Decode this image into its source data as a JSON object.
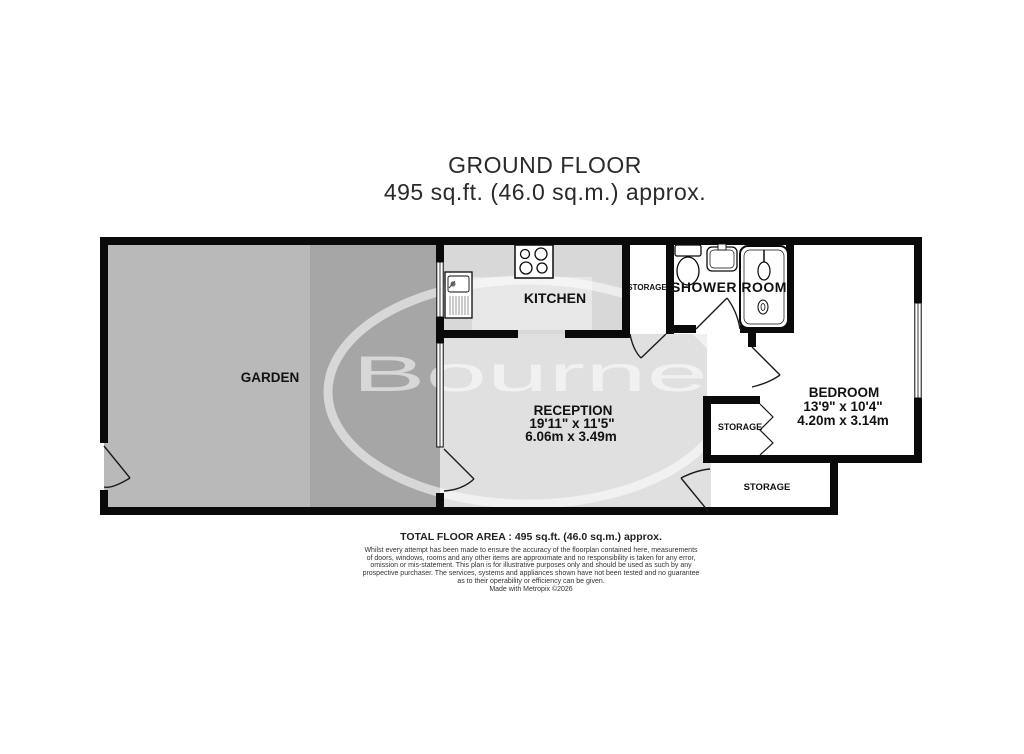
{
  "title": {
    "line1": "GROUND FLOOR",
    "line2": "495 sq.ft. (46.0 sq.m.) approx."
  },
  "watermark": {
    "text": "Bourne"
  },
  "rooms": {
    "garden": {
      "label": "GARDEN"
    },
    "kitchen": {
      "label": "KITCHEN"
    },
    "storage_top": {
      "label": "STORAGE"
    },
    "shower_room": {
      "label": "SHOWER ROOM"
    },
    "reception": {
      "label": "RECEPTION",
      "dim_imperial": "19'11\" x 11'5\"",
      "dim_metric": "6.06m x 3.49m"
    },
    "bedroom": {
      "label": "BEDROOM",
      "dim_imperial": "13'9\" x 10'4\"",
      "dim_metric": "4.20m x 3.14m"
    },
    "storage_closet": {
      "label": "STORAGE"
    },
    "storage_bottom": {
      "label": "STORAGE"
    }
  },
  "footer": {
    "total_area": "TOTAL FLOOR AREA : 495 sq.ft. (46.0 sq.m.) approx.",
    "disclaimer_lines": [
      "Whilst every attempt has been made to ensure the accuracy of the floorplan contained here, measurements",
      "of doors, windows, rooms and any other items are approximate and no responsibility is taken for any error,",
      "omission or mis-statement. This plan is for illustrative purposes only and should be used as such by any",
      "prospective purchaser. The services, systems and appliances shown have not been tested and no guarantee",
      "as to their operability or efficiency can be given."
    ],
    "made_with": "Made with Metropix ©2026"
  },
  "colors": {
    "wall": "#0a0a0a",
    "garden_left": "#b9b9b9",
    "garden_right": "#a6a6a6",
    "kitchen_floor": "#d8d8d8",
    "kitchen_counter": "#e7e7e7",
    "reception_floor": "#e0e0e0",
    "room_white": "#ffffff"
  }
}
